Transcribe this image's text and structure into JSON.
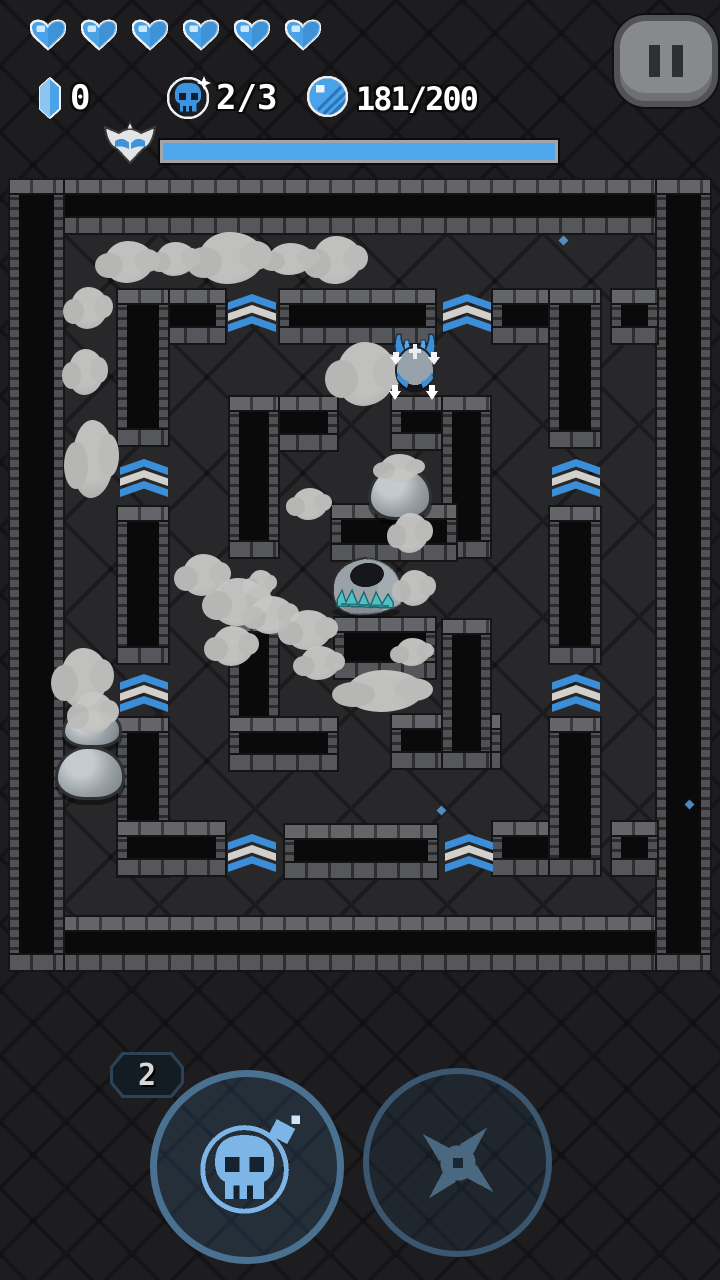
{
  "hud": {
    "hearts": {
      "count": 6,
      "color": "#4aa2e8"
    },
    "crystal": {
      "value": "0",
      "icon": "crystal-icon"
    },
    "bombs": {
      "value": "2/3",
      "icon": "skull-bomb-icon"
    },
    "coins": {
      "value": "181/200",
      "icon": "coin-icon"
    },
    "boss_bar": {
      "fill_pct": 100,
      "fill_color": "#4fa8ec",
      "icon": "winged-skull-icon"
    },
    "pause": {
      "icon": "pause-icon"
    }
  },
  "controls": {
    "bomb_button": {
      "badge": "2",
      "icon": "skull-bomb-icon",
      "enabled": true
    },
    "shuriken_button": {
      "icon": "shuriken-icon",
      "enabled": false
    }
  },
  "colors": {
    "background": "#1d1d1f",
    "floor": "#28282b",
    "wall": "#0a0a0b",
    "brick_light": "#646568",
    "chevron_blue": "#3c8ed8",
    "chevron_white": "#d2d0cc",
    "hud_blue": "#4aa2e8",
    "smoke": "#c0c0be"
  },
  "maze": {
    "origin": [
      10,
      180
    ],
    "floor": [
      63,
      233,
      594,
      684
    ],
    "walls": [
      [
        10,
        180,
        700,
        53
      ],
      [
        10,
        917,
        700,
        53
      ],
      [
        10,
        180,
        53,
        790
      ],
      [
        657,
        180,
        53,
        790
      ],
      [
        118,
        290,
        107,
        53
      ],
      [
        118,
        290,
        50,
        155
      ],
      [
        280,
        290,
        155,
        53
      ],
      [
        493,
        290,
        107,
        53
      ],
      [
        550,
        290,
        50,
        157
      ],
      [
        612,
        290,
        45,
        53
      ],
      [
        118,
        507,
        50,
        156
      ],
      [
        550,
        507,
        50,
        156
      ],
      [
        118,
        718,
        50,
        158
      ],
      [
        118,
        822,
        107,
        53
      ],
      [
        285,
        825,
        152,
        53
      ],
      [
        493,
        822,
        107,
        53
      ],
      [
        550,
        718,
        50,
        157
      ],
      [
        612,
        822,
        45,
        53
      ],
      [
        230,
        397,
        107,
        53
      ],
      [
        230,
        397,
        48,
        160
      ],
      [
        392,
        397,
        98,
        52
      ],
      [
        443,
        397,
        47,
        160
      ],
      [
        230,
        618,
        48,
        150
      ],
      [
        230,
        718,
        107,
        52
      ],
      [
        392,
        715,
        108,
        53
      ],
      [
        443,
        620,
        47,
        148
      ],
      [
        332,
        505,
        124,
        55
      ],
      [
        335,
        618,
        100,
        60
      ]
    ],
    "chevrons": [
      [
        228,
        294
      ],
      [
        443,
        294
      ],
      [
        120,
        459
      ],
      [
        552,
        459
      ],
      [
        120,
        674
      ],
      [
        552,
        674
      ],
      [
        228,
        834
      ],
      [
        445,
        834
      ]
    ],
    "clouds": [
      [
        104,
        241,
        50,
        42
      ],
      [
        156,
        242,
        40,
        34
      ],
      [
        198,
        232,
        66,
        52
      ],
      [
        268,
        243,
        46,
        32
      ],
      [
        312,
        236,
        50,
        48
      ],
      [
        70,
        287,
        38,
        42
      ],
      [
        68,
        349,
        36,
        46
      ],
      [
        72,
        420,
        42,
        78
      ],
      [
        336,
        342,
        60,
        64
      ],
      [
        380,
        454,
        40,
        28
      ],
      [
        292,
        488,
        36,
        32
      ],
      [
        393,
        513,
        36,
        40
      ],
      [
        398,
        570,
        34,
        36
      ],
      [
        248,
        570,
        26,
        28
      ],
      [
        182,
        554,
        44,
        42
      ],
      [
        212,
        578,
        54,
        48
      ],
      [
        250,
        596,
        44,
        38
      ],
      [
        286,
        610,
        46,
        40
      ],
      [
        212,
        626,
        42,
        40
      ],
      [
        300,
        646,
        40,
        34
      ],
      [
        346,
        670,
        78,
        42
      ],
      [
        396,
        638,
        34,
        28
      ],
      [
        60,
        648,
        48,
        60
      ],
      [
        74,
        692,
        40,
        42
      ]
    ],
    "rocks": [
      [
        368,
        466,
        58,
        48
      ],
      [
        62,
        708,
        54,
        34
      ],
      [
        55,
        746,
        64,
        48
      ]
    ],
    "specks": [
      [
        560,
        237
      ],
      [
        686,
        801
      ],
      [
        438,
        807
      ]
    ],
    "entities": {
      "player": [
        385,
        330,
        60,
        72
      ],
      "skull_boulder": [
        327,
        552,
        78,
        66
      ]
    }
  }
}
